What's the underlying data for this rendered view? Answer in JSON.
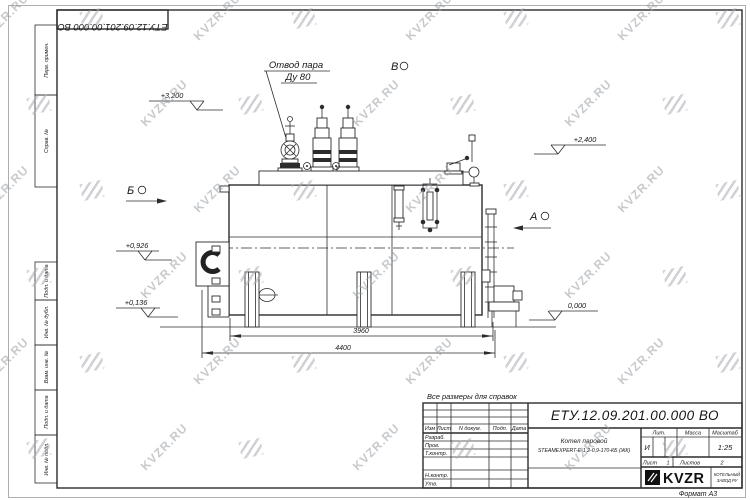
{
  "watermark": {
    "text": "KVZR.RU"
  },
  "stamp": {
    "code": "ЕТУ.12.09.201.00.000  ВО"
  },
  "margin": {
    "top": [
      "Перв. примен.",
      "Справ. №"
    ],
    "bottom": [
      "Подп. и дата",
      "Инв. № дубл.",
      "Взам. инв. №",
      "Подп. и дата",
      "Инв. № подл."
    ]
  },
  "callout": {
    "line1": "Отвод пара",
    "line2": "Ду 80"
  },
  "views": {
    "left": "Б",
    "top": "В",
    "right": "А"
  },
  "elevations": {
    "top": "+3,200",
    "right": "+2,400",
    "mid": "+0,926",
    "low": "+0,136",
    "zero": "0,000"
  },
  "dims": {
    "inner": "3960",
    "outer": "4400"
  },
  "note": "Все размеры для справок",
  "tb": {
    "doc": "ЕТУ.12.09.201.00.000  ВО",
    "name1": "Котел паровой",
    "name2": "STEAMEXPERT-Е-1,2-0,9-170-КБ (ЖК)",
    "h_izm": "Изм",
    "h_list": "Лист",
    "h_ndoc": "N докум.",
    "h_podp": "Подп.",
    "h_data": "Дата",
    "r1": "Разраб.",
    "r2": "Пров.",
    "r3": "Т.контр.",
    "r4": "Н.контр.",
    "r5": "Утв.",
    "h_lit": "Лит.",
    "h_massa": "Масса",
    "h_scale": "Масштаб",
    "lit": "И",
    "scale": "1:25",
    "sheet_l": "Лист",
    "sheet_v": "1",
    "sheets_l": "Листов",
    "sheets_v": "2",
    "logo": "KVZR",
    "logo_s1": "КОТЕЛЬНЫЙ",
    "logo_s2": "ЗАВОД РУ",
    "format": "Формат А3"
  }
}
